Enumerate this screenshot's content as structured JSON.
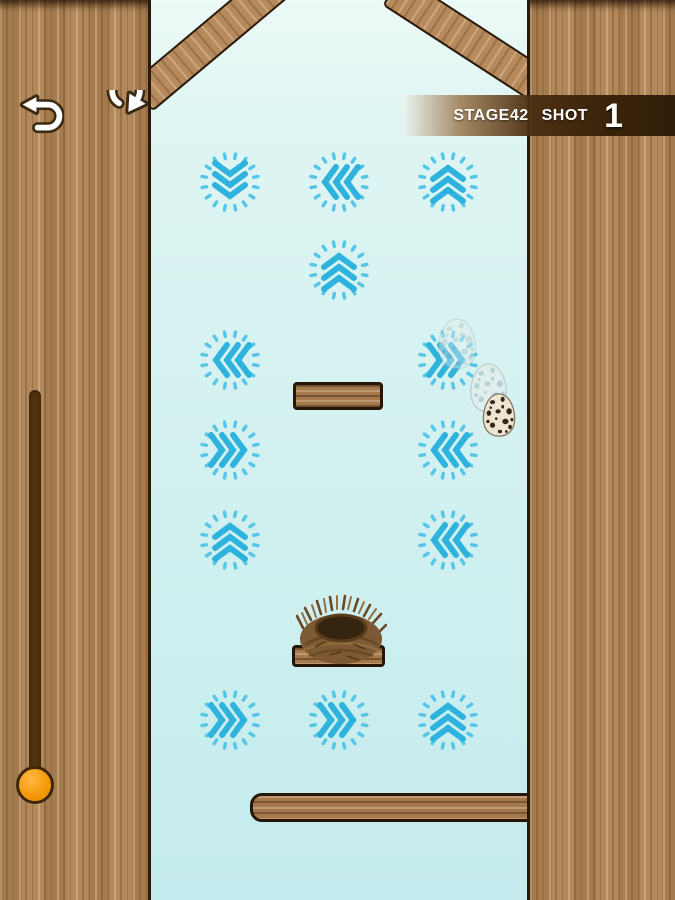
{
  "hud": {
    "stage": "STAGE42",
    "shot_label": "SHOT",
    "shot_value": "1"
  },
  "controls": {
    "undo_label": "undo",
    "restart_label": "restart"
  },
  "colors": {
    "chevron": "#2eb3de",
    "tick": "#55c6e8",
    "bg_top": "#edfaf6",
    "bg_bottom": "#c4ebed",
    "wood_base": "#b3885a",
    "hud_bar": "#3a230b",
    "knob_orange": "#f59a0a",
    "slider_track": "#50340d"
  },
  "icons": {
    "undo": "undo-arrow-icon",
    "restart": "restart-arrow-icon"
  },
  "indicators": [
    {
      "x": 230,
      "y": 182,
      "dir": "down"
    },
    {
      "x": 339,
      "y": 182,
      "dir": "left"
    },
    {
      "x": 448,
      "y": 182,
      "dir": "up"
    },
    {
      "x": 339,
      "y": 270,
      "dir": "up"
    },
    {
      "x": 230,
      "y": 360,
      "dir": "left"
    },
    {
      "x": 448,
      "y": 360,
      "dir": "right"
    },
    {
      "x": 230,
      "y": 450,
      "dir": "right"
    },
    {
      "x": 448,
      "y": 450,
      "dir": "left"
    },
    {
      "x": 230,
      "y": 540,
      "dir": "up"
    },
    {
      "x": 448,
      "y": 540,
      "dir": "left"
    },
    {
      "x": 230,
      "y": 720,
      "dir": "right"
    },
    {
      "x": 339,
      "y": 720,
      "dir": "right"
    },
    {
      "x": 448,
      "y": 720,
      "dir": "up"
    }
  ],
  "planks": [
    {
      "x": 293,
      "y": 382,
      "w": 90,
      "h": 28,
      "kind": "block"
    },
    {
      "x": 292,
      "y": 645,
      "w": 93,
      "h": 22,
      "kind": "block"
    },
    {
      "x": 250,
      "y": 793,
      "w": 281,
      "h": 29,
      "kind": "longbeam"
    }
  ],
  "nest": {
    "x": 295,
    "y": 592,
    "w": 92,
    "h": 74
  },
  "eggs": [
    {
      "cx": 457,
      "cy": 344,
      "w": 46,
      "h": 54,
      "opacity": 0.4,
      "variant": "ghost"
    },
    {
      "cx": 488,
      "cy": 388,
      "w": 45,
      "h": 52,
      "opacity": 0.65,
      "variant": "ghost"
    },
    {
      "cx": 499,
      "cy": 415,
      "w": 38,
      "h": 46,
      "opacity": 1,
      "variant": "solid"
    }
  ],
  "slider": {
    "track": {
      "x": 29,
      "y": 390,
      "w": 12,
      "h": 402
    },
    "knob": {
      "cx": 35,
      "cy": 785,
      "d": 38
    }
  }
}
